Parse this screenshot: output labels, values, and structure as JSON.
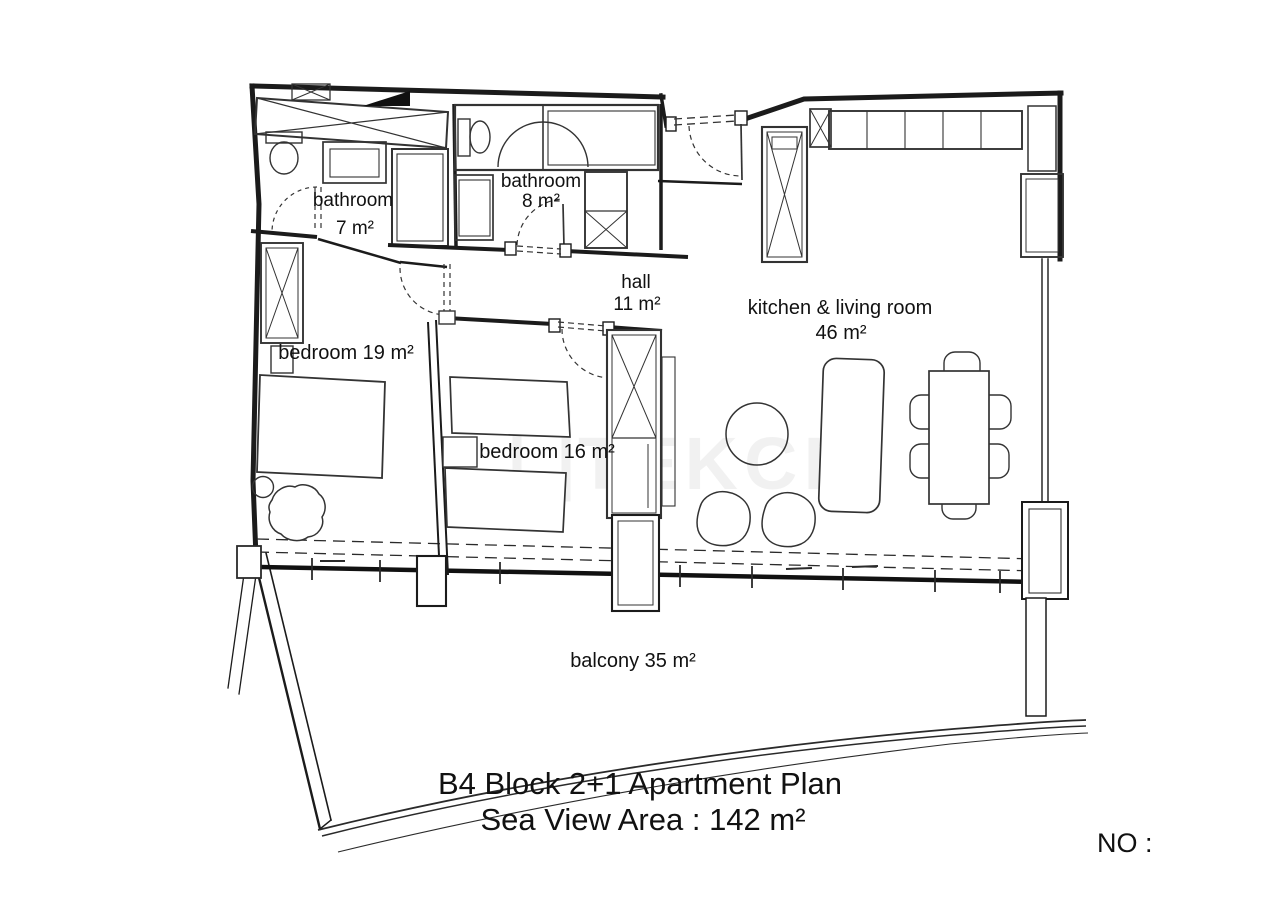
{
  "plan": {
    "watermark": "TEKCE",
    "rooms": {
      "bathroom1": {
        "name": "bathroom",
        "area": "7 m²"
      },
      "bathroom2": {
        "name": "bathroom",
        "area": "8 m²"
      },
      "hall": {
        "name": "hall",
        "area": "11 m²"
      },
      "kitchen_living": {
        "name": "kitchen & living room",
        "area": "46 m²"
      },
      "bedroom1": {
        "name": "bedroom 19 m²"
      },
      "bedroom2": {
        "name": "bedroom 16 m²"
      },
      "balcony": {
        "name": "balcony 35 m²"
      }
    },
    "footer": {
      "title": "B4 Block 2+1 Apartment Plan",
      "subtitle": "Sea View Area : 142 m²",
      "no_label": "NO :"
    },
    "colors": {
      "wall": "#1b1b1b",
      "interior_line": "#333333",
      "background": "#ffffff"
    }
  }
}
